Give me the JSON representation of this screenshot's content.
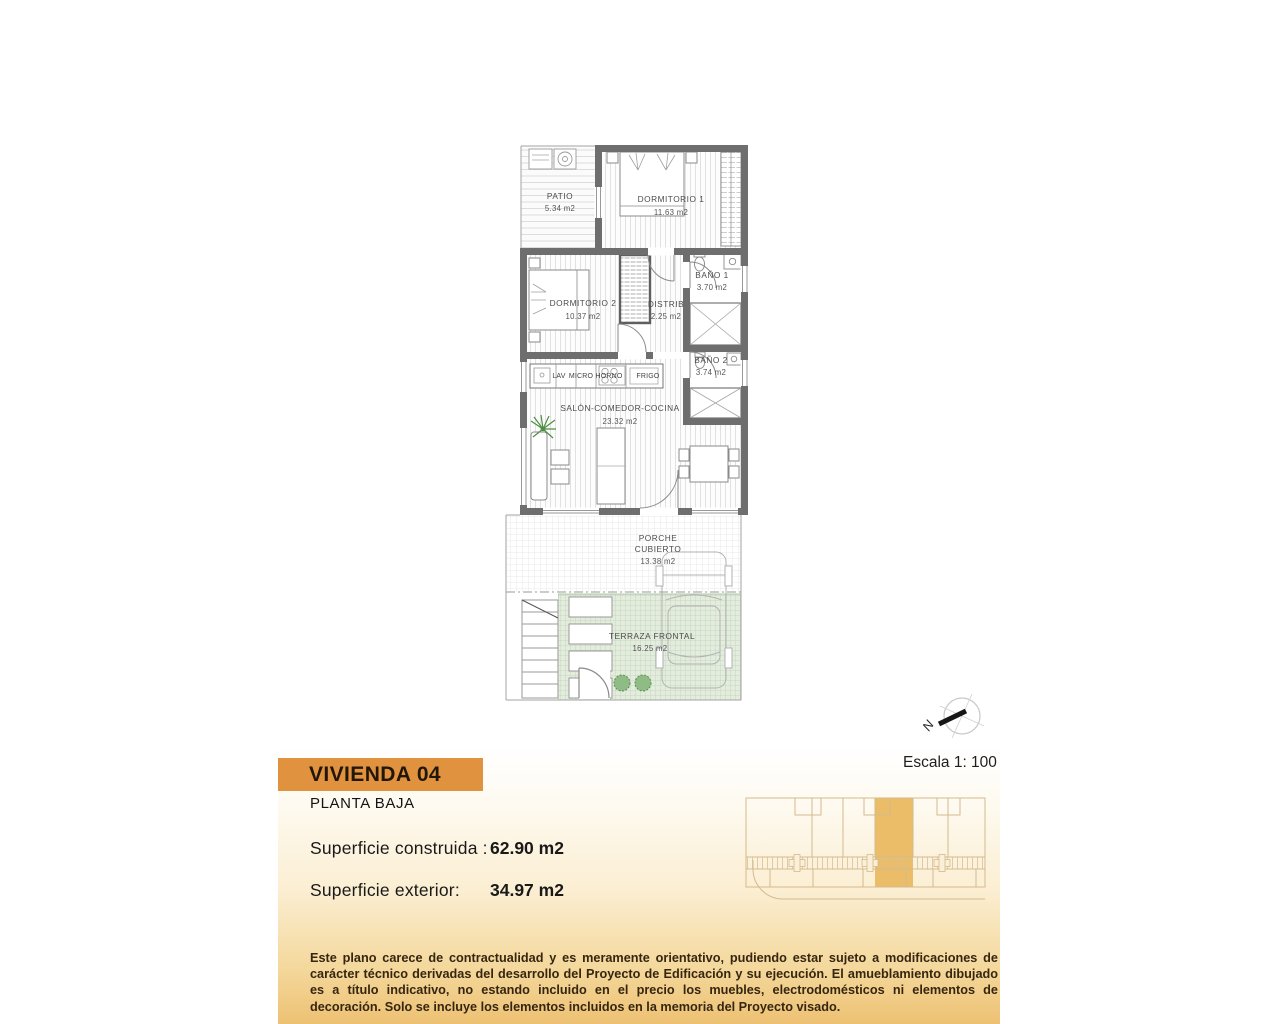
{
  "plan": {
    "rooms": [
      {
        "name": "PATIO",
        "area": "5.34 m2"
      },
      {
        "name": "DORMITORIO 1",
        "area": "11.63 m2"
      },
      {
        "name": "DORMITORIO 2",
        "area": "10.37 m2"
      },
      {
        "name": "DISTRIB",
        "area": "2.25 m2"
      },
      {
        "name": "BAÑO 1",
        "area": "3.70 m2"
      },
      {
        "name": "BAÑO 2",
        "area": "3.74 m2"
      },
      {
        "name": "SALÓN-COMEDOR-COCINA",
        "area": "23.32 m2"
      },
      {
        "name": "PORCHE",
        "name2": "CUBIERTO",
        "area": "13.38 m2"
      },
      {
        "name": "TERRAZA FRONTAL",
        "area": "16.25 m2"
      }
    ],
    "kitchen": {
      "labels": [
        "LAV",
        "MICRO",
        "HORNO",
        "FRIGO"
      ]
    },
    "compass": {
      "label": "N"
    }
  },
  "titleblock": {
    "unit_title": "VIVIENDA 04",
    "floor_label": "PLANTA BAJA",
    "scale_label": "Escala 1: 100",
    "metrics": [
      {
        "label": "Superficie construida :",
        "value": "62.90 m2"
      },
      {
        "label": "Superficie exterior:",
        "value": "34.97 m2"
      }
    ],
    "disclaimer": "Este plano carece de contractualidad y es meramente orientativo, pudiendo estar sujeto a modificaciones de carácter técnico derivadas del desarrollo del Proyecto de Edificación y su ejecución. El amueblamiento dibujado es a título indicativo, no estando incluido en el precio los muebles, electrodomésticos ni elementos de decoración. Solo se incluye los elementos incluidos en la memoria del Proyecto visado."
  },
  "colors": {
    "banner_orange": "#e0923e",
    "site_highlight_orange": "#ecbd68",
    "wall_gray": "#6e6e6e",
    "terrace_green": "#e3ecdd",
    "gradient_bottom": "#edc173"
  }
}
